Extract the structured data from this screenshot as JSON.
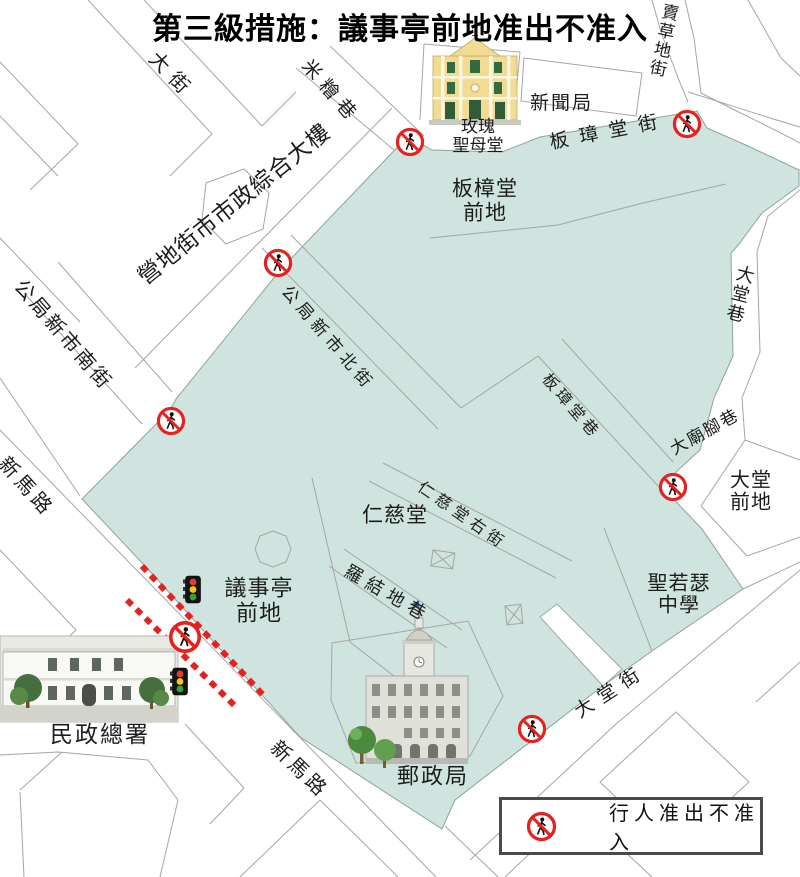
{
  "title": "第三級措施：議事亭前地准出不准入",
  "legend": {
    "label": "行人准出不准入"
  },
  "colors": {
    "restricted_zone": "#cfe4df",
    "alert_red": "#e42320",
    "title_red": "#e8231f",
    "street_line": "#a5a5a5"
  },
  "icons": {
    "no_entry": "no-pedestrian-icon",
    "traffic_light": "traffic-light-icon"
  },
  "labels": [
    {
      "name": "street-da-jie",
      "text": "大街",
      "x": 160,
      "y": 48,
      "rot": 46,
      "size": 20,
      "ls": 8,
      "mode": "h"
    },
    {
      "name": "lane-mi-kuai-hang",
      "text": "米糩巷",
      "x": 313,
      "y": 56,
      "rot": 49,
      "size": 19,
      "ls": 7,
      "mode": "h"
    },
    {
      "name": "building-yingdi-municipal-complex",
      "text": "營地街市市政綜合大樓",
      "x": 133,
      "y": 270,
      "rot": -39,
      "size": 23,
      "ls": 1,
      "mode": "h"
    },
    {
      "name": "street-gongju-south",
      "text": "公局新市南街",
      "x": 26,
      "y": 276,
      "rot": 49,
      "size": 20,
      "ls": 3,
      "mode": "h"
    },
    {
      "name": "road-san-ma-lo-west",
      "text": "新馬路",
      "x": 10,
      "y": 453,
      "rot": 48,
      "size": 20,
      "ls": 4,
      "mode": "h"
    },
    {
      "name": "street-gongju-north",
      "text": "公局新市北街",
      "x": 292,
      "y": 282,
      "rot": 49,
      "size": 17,
      "ls": 5,
      "mode": "h"
    },
    {
      "name": "street-banzhang-street",
      "text": "板璋堂街",
      "x": 548,
      "y": 133,
      "rot": -11,
      "size": 19,
      "ls": 11,
      "mode": "h"
    },
    {
      "name": "street-maicaodi",
      "text": "賣草地街",
      "x": 664,
      "y": 2,
      "rot": 12,
      "size": 17,
      "ls": 0,
      "mode": "v"
    },
    {
      "name": "bureau-xinwenju",
      "text": "新聞局",
      "x": 530,
      "y": 93,
      "rot": 0,
      "size": 19,
      "ls": 2,
      "mode": "h"
    },
    {
      "name": "church-meigui-label",
      "text": "玫瑰\n聖母堂",
      "x": 478,
      "y": 136,
      "rot": 0,
      "size": 17,
      "ls": 0,
      "mode": "c"
    },
    {
      "name": "square-banzhang-qiandi",
      "text": "板樟堂\n前地",
      "x": 485,
      "y": 201,
      "rot": 0,
      "size": 21,
      "ls": 1,
      "mode": "c"
    },
    {
      "name": "lane-datang-hang",
      "text": "大堂巷",
      "x": 739,
      "y": 263,
      "rot": 14,
      "size": 18,
      "ls": 0,
      "mode": "v"
    },
    {
      "name": "lane-banzhang-hang",
      "text": "板璋堂巷",
      "x": 551,
      "y": 371,
      "rot": 49,
      "size": 16,
      "ls": 4,
      "mode": "h"
    },
    {
      "name": "lane-damiaojiao",
      "text": "大廟腳巷",
      "x": 667,
      "y": 442,
      "rot": -29,
      "size": 17,
      "ls": 2,
      "mode": "h"
    },
    {
      "name": "square-datang-qiandi",
      "text": "大堂前地",
      "x": 751,
      "y": 492,
      "rot": 0,
      "size": 20,
      "ls": 1,
      "mode": "c"
    },
    {
      "name": "building-rencitang",
      "text": "仁慈堂",
      "x": 395,
      "y": 516,
      "rot": 0,
      "size": 21,
      "ls": 1,
      "mode": "c"
    },
    {
      "name": "street-rencitang-right",
      "text": "仁慈堂右街",
      "x": 424,
      "y": 479,
      "rot": 35,
      "size": 16,
      "ls": 5,
      "mode": "h"
    },
    {
      "name": "lane-luojiedi",
      "text": "羅結地巷",
      "x": 351,
      "y": 561,
      "rot": 30,
      "size": 18,
      "ls": 6,
      "mode": "h"
    },
    {
      "name": "square-yishiting-qiandi",
      "text": "議事亭\n前地",
      "x": 259,
      "y": 601,
      "rot": 0,
      "size": 22,
      "ls": 1,
      "mode": "c"
    },
    {
      "name": "school-st-joseph",
      "text": "聖若瑟\n中學",
      "x": 679,
      "y": 595,
      "rot": 0,
      "size": 20,
      "ls": 1,
      "mode": "c"
    },
    {
      "name": "building-civic-affairs",
      "text": "民政總署",
      "x": 100,
      "y": 735,
      "rot": 0,
      "size": 23,
      "ls": 2,
      "mode": "c"
    },
    {
      "name": "building-post-office",
      "text": "郵政局",
      "x": 433,
      "y": 777,
      "rot": 0,
      "size": 22,
      "ls": 2,
      "mode": "c"
    },
    {
      "name": "street-datang-street",
      "text": "大堂街",
      "x": 571,
      "y": 705,
      "rot": -33,
      "size": 19,
      "ls": 8,
      "mode": "h"
    },
    {
      "name": "road-san-ma-lo-south",
      "text": "新馬路",
      "x": 281,
      "y": 737,
      "rot": 44,
      "size": 20,
      "ls": 4,
      "mode": "h"
    }
  ],
  "no_entry_points": [
    {
      "name": "no-entry-mi-kuai-hang",
      "x": 410,
      "y": 142,
      "r": 15
    },
    {
      "name": "no-entry-maicaodi",
      "x": 687,
      "y": 124,
      "r": 15
    },
    {
      "name": "no-entry-gongju-north",
      "x": 278,
      "y": 263,
      "r": 15
    },
    {
      "name": "no-entry-gongju-south",
      "x": 171,
      "y": 421,
      "r": 15
    },
    {
      "name": "no-entry-damiaojiao",
      "x": 673,
      "y": 487,
      "r": 15
    },
    {
      "name": "no-entry-yishiting-sanmalo",
      "x": 185,
      "y": 637,
      "r": 17
    },
    {
      "name": "no-entry-datang-street",
      "x": 532,
      "y": 729,
      "r": 15
    }
  ]
}
